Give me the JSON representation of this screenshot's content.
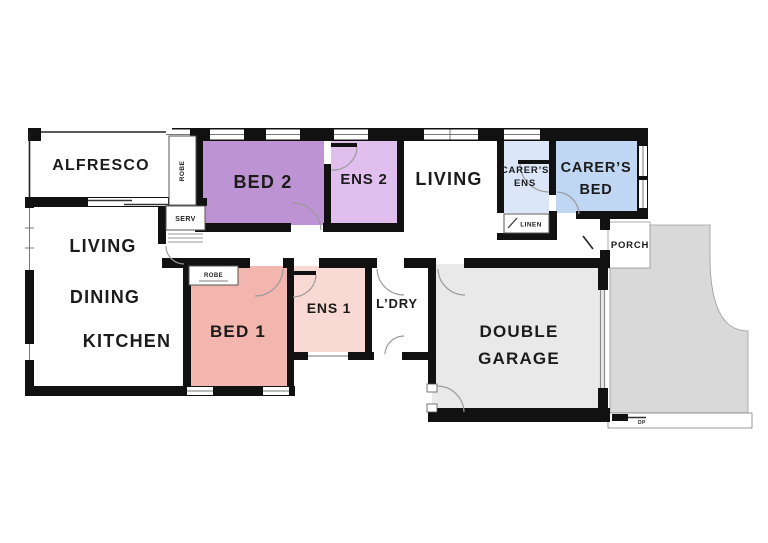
{
  "floorplan": {
    "rooms": {
      "alfresco": {
        "label": "ALFRESCO"
      },
      "living_main": {
        "label": "LIVING"
      },
      "dining": {
        "label": "DINING"
      },
      "kitchen": {
        "label": "KITCHEN"
      },
      "bed2": {
        "label": "BED 2",
        "color": "#bd93d3"
      },
      "ens2": {
        "label": "ENS 2",
        "color": "#e0bfef"
      },
      "living_top": {
        "label": "LIVING"
      },
      "carers_ens": {
        "label_line1": "CARER’S",
        "label_line2": "ENS",
        "color": "#dbe6f8"
      },
      "carers_bed": {
        "label_line1": "CARER’S",
        "label_line2": "BED",
        "color": "#c0d7f4"
      },
      "bed1": {
        "label": "BED 1",
        "color": "#f2b6ae"
      },
      "ens1": {
        "label": "ENS 1",
        "color": "#f8d9d3"
      },
      "ldry": {
        "label": "L’DRY"
      },
      "garage": {
        "label_line1": "DOUBLE",
        "label_line2": "GARAGE",
        "color": "#e9e9e9"
      },
      "porch": {
        "label": "PORCH"
      }
    },
    "fixtures": {
      "robe_bed2": "ROBE",
      "serv": "SERV",
      "linen": "LINEN",
      "robe_bed1": "ROBE",
      "dp": "DP"
    },
    "colors": {
      "wall": "#111111",
      "driveway": "#d9d9d9",
      "interior": "#ffffff",
      "door_arc": "#9a9a9a"
    }
  }
}
